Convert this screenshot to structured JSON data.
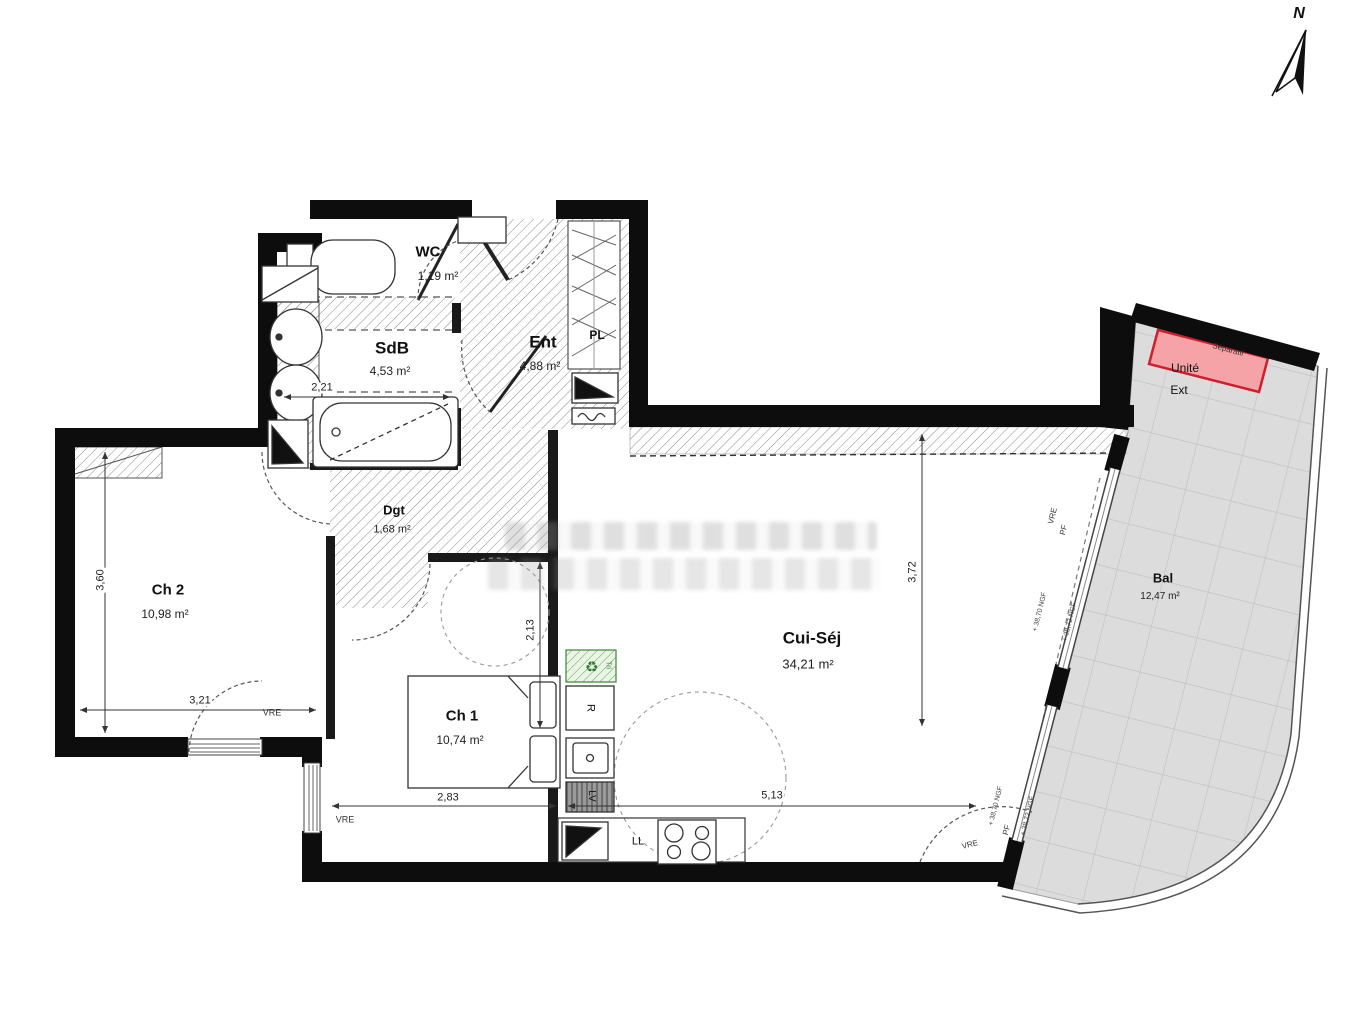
{
  "compass": {
    "label": "N"
  },
  "rooms": {
    "wc": {
      "name": "WC",
      "area": "1,19 m²"
    },
    "sdb": {
      "name": "SdB",
      "area": "4,53 m²"
    },
    "ent": {
      "name": "Ent",
      "area": "4,88 m²"
    },
    "pl": {
      "name": "PL"
    },
    "dgt": {
      "name": "Dgt",
      "area": "1,68 m²"
    },
    "ch2": {
      "name": "Ch 2",
      "area": "10,98 m²"
    },
    "ch1": {
      "name": "Ch 1",
      "area": "10,74 m²"
    },
    "cui": {
      "name": "Cui-Séj",
      "area": "34,21 m²"
    },
    "bal": {
      "name": "Bal",
      "area": "12,47 m²"
    }
  },
  "dimensions": {
    "ch2_height": "3,60",
    "ch2_width": "3,21",
    "sdb_width": "2,21",
    "ch1_width": "2,83",
    "ch1_height": "2,13",
    "cui_height": "3,72",
    "cui_width": "5,13"
  },
  "labels": {
    "vre": "VRE",
    "pf": "PF",
    "ngf_38_70": "+ 38,70 NGF",
    "ngf_38_72": "+ 38,72 NGF",
    "separatif": "Séparatif",
    "unite": "Unité",
    "ext": "Ext",
    "tri": "Tri",
    "fridge": "R",
    "dishwasher": "LV",
    "washer": "LL"
  },
  "colors": {
    "wall": "#0d0d0d",
    "hatch_line": "#8a8a8a",
    "balcony_fill": "#dcdcdc",
    "balcony_grid": "#bfbfbf",
    "ac_unit_fill": "#f5a3a6",
    "ac_unit_border": "#cf1f2e",
    "tri_green": "#2f7d32"
  }
}
